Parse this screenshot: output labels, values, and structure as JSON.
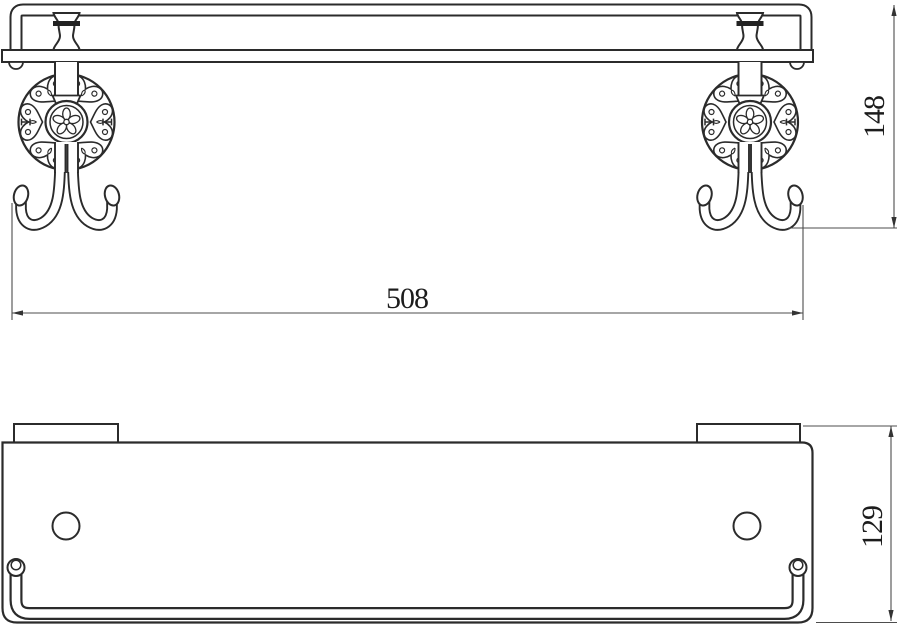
{
  "drawing": {
    "background": "#ffffff",
    "object_line_color": "#2b2b2b",
    "ornament_line_color": "#2b2b2b",
    "dim_line_color": "#4d4d4d",
    "dim_text_color": "#1c1c1c",
    "dimensions": [
      {
        "id": "overall-width",
        "value": "508"
      },
      {
        "id": "overall-height",
        "value": "148"
      },
      {
        "id": "overall-depth",
        "value": "129"
      }
    ]
  }
}
